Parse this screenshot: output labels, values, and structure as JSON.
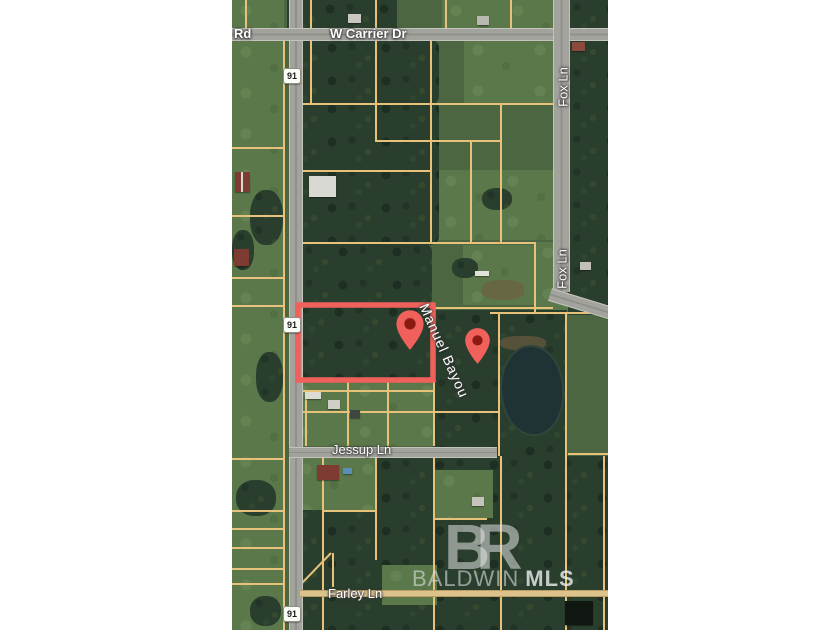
{
  "map": {
    "type": "satellite-parcel-map",
    "labels": {
      "rd_partial": "Rd",
      "w_carrier_dr": "W Carrier Dr",
      "fox_ln_upper": "Fox Ln",
      "fox_ln_lower": "Fox Ln",
      "manuel_bayou": "Manuel Bayou",
      "jessup_ln": "Jessup Ln",
      "farley_ln": "Farley Ln"
    },
    "route_shields": [
      {
        "label": "91"
      },
      {
        "label": "91"
      },
      {
        "label": "91"
      }
    ],
    "property": {
      "outline_color": "#f0615c",
      "pins": [
        {
          "id": "pin-primary",
          "color": "#f0615c",
          "hole_color": "#8a1a12"
        },
        {
          "id": "pin-secondary",
          "color": "#f0615c",
          "hole_color": "#8a1a12"
        }
      ]
    },
    "watermark": {
      "logo": "BR",
      "name": "BALDWIN",
      "suffix": "MLS"
    },
    "colors": {
      "margin": "#ffffff",
      "field_green": "#5b784b",
      "forest_green": "#2a3e2e",
      "road_gray": "#a3a39d",
      "parcel_line_tan": "#e8c17a",
      "water": "#1f3334"
    }
  }
}
